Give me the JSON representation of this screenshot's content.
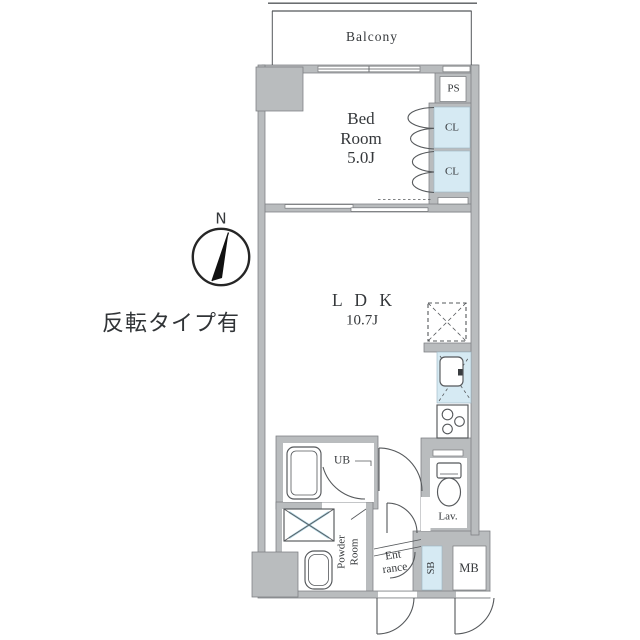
{
  "note": "反転タイプ有",
  "compass": {
    "north": "N"
  },
  "plan": {
    "balcony": "Balcony",
    "bedroom": {
      "l1": "Bed",
      "l2": "Room",
      "size": "5.0J"
    },
    "ldk": {
      "name": "L D K",
      "size": "10.7J"
    },
    "ps": "PS",
    "cl_upper": "CL",
    "cl_lower": "CL",
    "ub": "UB",
    "powder_room": "Powder Room",
    "entrance": {
      "l1": "Ent",
      "l2": "rance"
    },
    "lav": "Lav.",
    "sb": "SB",
    "mb": "MB"
  },
  "colors": {
    "wall": "#b9bcbe",
    "wall_edge": "#7b7e81",
    "closet_blue": "#d6eaf3",
    "line": "#55585b",
    "text": "#35383b"
  }
}
